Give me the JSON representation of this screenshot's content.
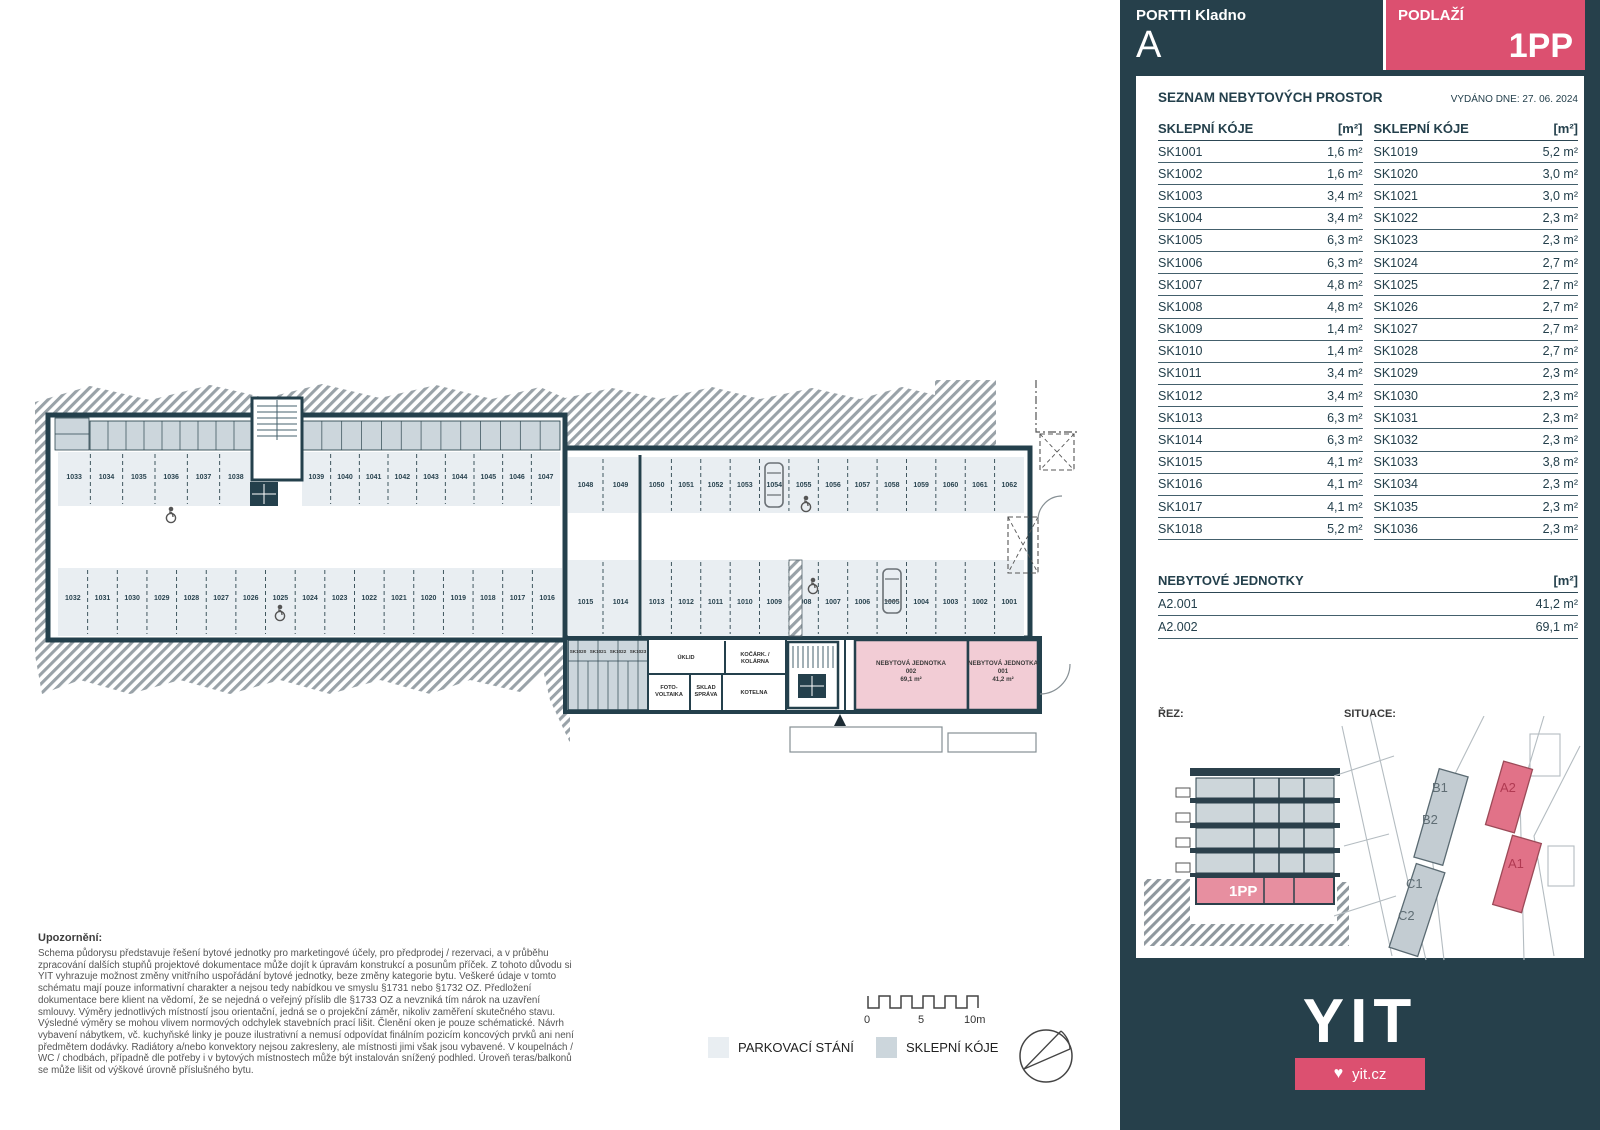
{
  "header": {
    "project": "PORTTI Kladno",
    "building": "A",
    "floor_label": "PODLAŽÍ",
    "floor": "1PP"
  },
  "panel": {
    "title": "SEZNAM NEBYTOVÝCH PROSTOR",
    "issued_label": "VYDÁNO DNE:",
    "issued_date": "27. 06. 2024",
    "col_header": "SKLEPNÍ KÓJE",
    "unit_header": "[m²]",
    "storage_left": [
      {
        "id": "SK1001",
        "area": "1,6 m²"
      },
      {
        "id": "SK1002",
        "area": "1,6 m²"
      },
      {
        "id": "SK1003",
        "area": "3,4 m²"
      },
      {
        "id": "SK1004",
        "area": "3,4 m²"
      },
      {
        "id": "SK1005",
        "area": "6,3 m²"
      },
      {
        "id": "SK1006",
        "area": "6,3 m²"
      },
      {
        "id": "SK1007",
        "area": "4,8 m²"
      },
      {
        "id": "SK1008",
        "area": "4,8 m²"
      },
      {
        "id": "SK1009",
        "area": "1,4 m²"
      },
      {
        "id": "SK1010",
        "area": "1,4 m²"
      },
      {
        "id": "SK1011",
        "area": "3,4 m²"
      },
      {
        "id": "SK1012",
        "area": "3,4 m²"
      },
      {
        "id": "SK1013",
        "area": "6,3 m²"
      },
      {
        "id": "SK1014",
        "area": "6,3 m²"
      },
      {
        "id": "SK1015",
        "area": "4,1 m²"
      },
      {
        "id": "SK1016",
        "area": "4,1 m²"
      },
      {
        "id": "SK1017",
        "area": "4,1 m²"
      },
      {
        "id": "SK1018",
        "area": "5,2 m²"
      }
    ],
    "storage_right": [
      {
        "id": "SK1019",
        "area": "5,2 m²"
      },
      {
        "id": "SK1020",
        "area": "3,0 m²"
      },
      {
        "id": "SK1021",
        "area": "3,0 m²"
      },
      {
        "id": "SK1022",
        "area": "2,3 m²"
      },
      {
        "id": "SK1023",
        "area": "2,3 m²"
      },
      {
        "id": "SK1024",
        "area": "2,7 m²"
      },
      {
        "id": "SK1025",
        "area": "2,7 m²"
      },
      {
        "id": "SK1026",
        "area": "2,7 m²"
      },
      {
        "id": "SK1027",
        "area": "2,7 m²"
      },
      {
        "id": "SK1028",
        "area": "2,7 m²"
      },
      {
        "id": "SK1029",
        "area": "2,3 m²"
      },
      {
        "id": "SK1030",
        "area": "2,3 m²"
      },
      {
        "id": "SK1031",
        "area": "2,3 m²"
      },
      {
        "id": "SK1032",
        "area": "2,3 m²"
      },
      {
        "id": "SK1033",
        "area": "3,8 m²"
      },
      {
        "id": "SK1034",
        "area": "2,3 m²"
      },
      {
        "id": "SK1035",
        "area": "2,3 m²"
      },
      {
        "id": "SK1036",
        "area": "2,3 m²"
      }
    ],
    "units_title": "NEBYTOVÉ JEDNOTKY",
    "units": [
      {
        "id": "A2.001",
        "area": "41,2 m²"
      },
      {
        "id": "A2.002",
        "area": "69,1 m²"
      }
    ],
    "rez_label": "ŘEZ:",
    "situace_label": "SITUACE:",
    "rez_floor": "1PP",
    "situace": {
      "b1": "B1",
      "b2": "B2",
      "c1": "C1",
      "c2": "C2",
      "a2": "A2",
      "a1": "A1"
    }
  },
  "plan": {
    "parking_rows": [
      {
        "id": "top-left-a",
        "x": 58,
        "y": 452,
        "w": 194,
        "h": 54,
        "ly": 479,
        "labels": [
          "1033",
          "1034",
          "1035",
          "1036",
          "1037",
          "1038"
        ]
      },
      {
        "id": "top-left-b",
        "x": 302,
        "y": 452,
        "w": 258,
        "h": 54,
        "ly": 479,
        "labels": [
          "1039",
          "1040",
          "1041",
          "1042",
          "1043",
          "1044",
          "1045",
          "1046",
          "1047"
        ]
      },
      {
        "id": "bottom-left",
        "x": 58,
        "y": 568,
        "w": 504,
        "h": 68,
        "ly": 600,
        "labels": [
          "1032",
          "1031",
          "1030",
          "1029",
          "1028",
          "1027",
          "1026",
          "1025",
          "1024",
          "1023",
          "1022",
          "1021",
          "1020",
          "1019",
          "1018",
          "1017",
          "1016"
        ]
      },
      {
        "id": "top-right-a",
        "x": 568,
        "y": 457,
        "w": 70,
        "h": 56,
        "ly": 487,
        "labels": [
          "1048",
          "1049"
        ]
      },
      {
        "id": "top-right-b",
        "x": 642,
        "y": 457,
        "w": 382,
        "h": 56,
        "ly": 487,
        "labels": [
          "1050",
          "1051",
          "1052",
          "1053",
          "1054",
          "1055",
          "1056",
          "1057",
          "1058",
          "1059",
          "1060",
          "1061",
          "1062"
        ]
      },
      {
        "id": "bottom-right-a",
        "x": 568,
        "y": 560,
        "w": 70,
        "h": 76,
        "ly": 604,
        "labels": [
          "1015",
          "1014"
        ]
      },
      {
        "id": "bottom-right-b",
        "x": 642,
        "y": 560,
        "w": 382,
        "h": 76,
        "ly": 604,
        "labels": [
          "1013",
          "1012",
          "1011",
          "1010",
          "1009",
          "1008",
          "1007",
          "1006",
          "1005",
          "1004",
          "1003",
          "1002",
          "1001"
        ]
      }
    ],
    "storage_bands": [
      {
        "x": 90,
        "y": 421,
        "w": 162,
        "h": 29,
        "cells": 9
      },
      {
        "x": 302,
        "y": 421,
        "w": 258,
        "h": 29,
        "cells": 13
      }
    ],
    "sk_labels": [
      {
        "t": "SK1020",
        "x": 578,
        "y": 653
      },
      {
        "t": "SK1021",
        "x": 598,
        "y": 653
      },
      {
        "t": "SK1022",
        "x": 618,
        "y": 653
      },
      {
        "t": "SK1023",
        "x": 638,
        "y": 653
      }
    ],
    "rooms": [
      {
        "lines": [
          "ÚKLID"
        ],
        "x": 686,
        "y": 659
      },
      {
        "lines": [
          "KOČÁRK. /",
          "KOLÁRNA"
        ],
        "x": 755,
        "y": 656
      },
      {
        "lines": [
          "FOTO-",
          "VOLTAIKA"
        ],
        "x": 669,
        "y": 689
      },
      {
        "lines": [
          "SKLAD",
          "SPRÁVA"
        ],
        "x": 706,
        "y": 689
      },
      {
        "lines": [
          "KOTELNA"
        ],
        "x": 754,
        "y": 694
      }
    ],
    "unit_labels": [
      {
        "lines": [
          "NEBYTOVÁ JEDNOTKA",
          "002",
          "69,1 m²"
        ],
        "x": 911,
        "y": 665
      },
      {
        "lines": [
          "NEBYTOVÁ JEDNOTKA",
          "001",
          "41,2 m²"
        ],
        "x": 1003,
        "y": 665
      }
    ]
  },
  "legend": {
    "parking": "PARKOVACÍ STÁNÍ",
    "storage": "SKLEPNÍ KÓJE",
    "scale": {
      "zero": "0",
      "five": "5",
      "ten": "10m"
    }
  },
  "disclaimer": {
    "title": "Upozornění:",
    "body": "Schema půdorysu představuje řešení bytové jednotky pro marketingové účely, pro předprodej / rezervaci, a v průběhu zpracování dalších stupňů projektové dokumentace může dojít k úpravám konstrukcí a posunům příček. Z tohoto důvodu si YIT vyhrazuje možnost změny vnitřního uspořádání bytové jednotky, beze změny kategorie bytu. Veškeré údaje v tomto schématu mají pouze informativní charakter a nejsou tedy nabídkou ve smyslu §1731 nebo §1732 OZ. Předložení dokumentace bere klient na vědomí, že se nejedná o veřejný příslib dle §1733 OZ a nevzniká tím nárok na uzavření smlouvy. Výměry jednotlivých místností jsou orientační, jedná se o projekční záměr, nikoliv zaměření skutečného stavu. Výsledné výměry se mohou vlivem normových odchylek stavebních prací lišit. Členění oken je pouze schématické. Návrh vybavení nábytkem, vč. kuchyňské linky je pouze ilustrativní a nemusí odpovídat finálním pozicím koncových prvků ani není předmětem dodávky. Radiátory a/nebo konvektory nejsou zakresleny, ale místnosti jimi však jsou vybavené. V koupelnách / WC / chodbách, případně dle potřeby i v bytových místnostech může být instalován snížený podhled. Úroveň teras/balkonů se může lišit od výškové úrovně příslušného bytu."
  },
  "footer": {
    "logo": "YIT",
    "heart": "♥",
    "site": "yit.cz"
  },
  "colors": {
    "sidebar": "#26404b",
    "accent_pink": "#dc5070",
    "unit_pink": "#f2ccd5",
    "stall_fill": "#e9eef2",
    "storage_fill": "#ccd6dc",
    "wall": "#24404c"
  }
}
